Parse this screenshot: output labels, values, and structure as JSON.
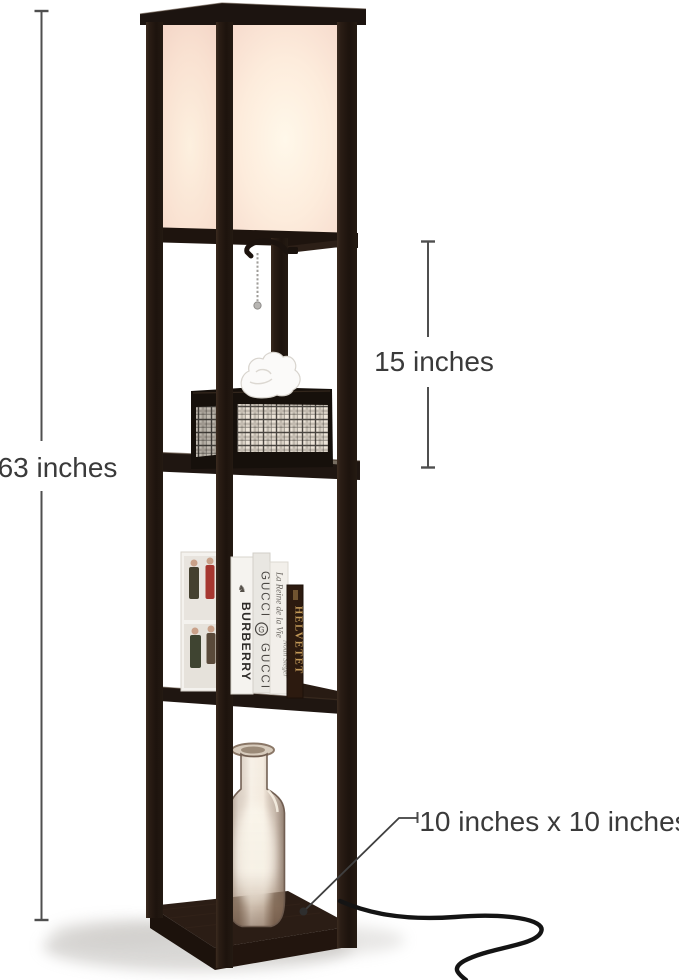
{
  "scene": {
    "type": "product-photo",
    "subject": "shelf-floor-lamp",
    "background": "#ffffff"
  },
  "annotations": {
    "height": {
      "label": "63 inches"
    },
    "shade": {
      "label": "15 inches"
    },
    "base": {
      "label": "10 inches x 10 inches"
    }
  },
  "books": {
    "burberry": "BURBERRY",
    "gucci_top": "GUCCI",
    "gucci_emblem": "G",
    "gucci_bottom": "GUCCI",
    "novel_title": "La Reine de la Vie",
    "novel_author": "Noah Sieger",
    "helvetet": "HELVETET"
  },
  "colors": {
    "frame_wood": "#241a14",
    "shade_glow": "#fff3e2",
    "shade_edge": "#f3d3c6",
    "annotation_ink": "#3a3a3a",
    "annotation_line": "#4f4f4f",
    "spine_gold": "#c49a58",
    "plaid_background": "#ece4d8",
    "cord_black": "#141414"
  }
}
